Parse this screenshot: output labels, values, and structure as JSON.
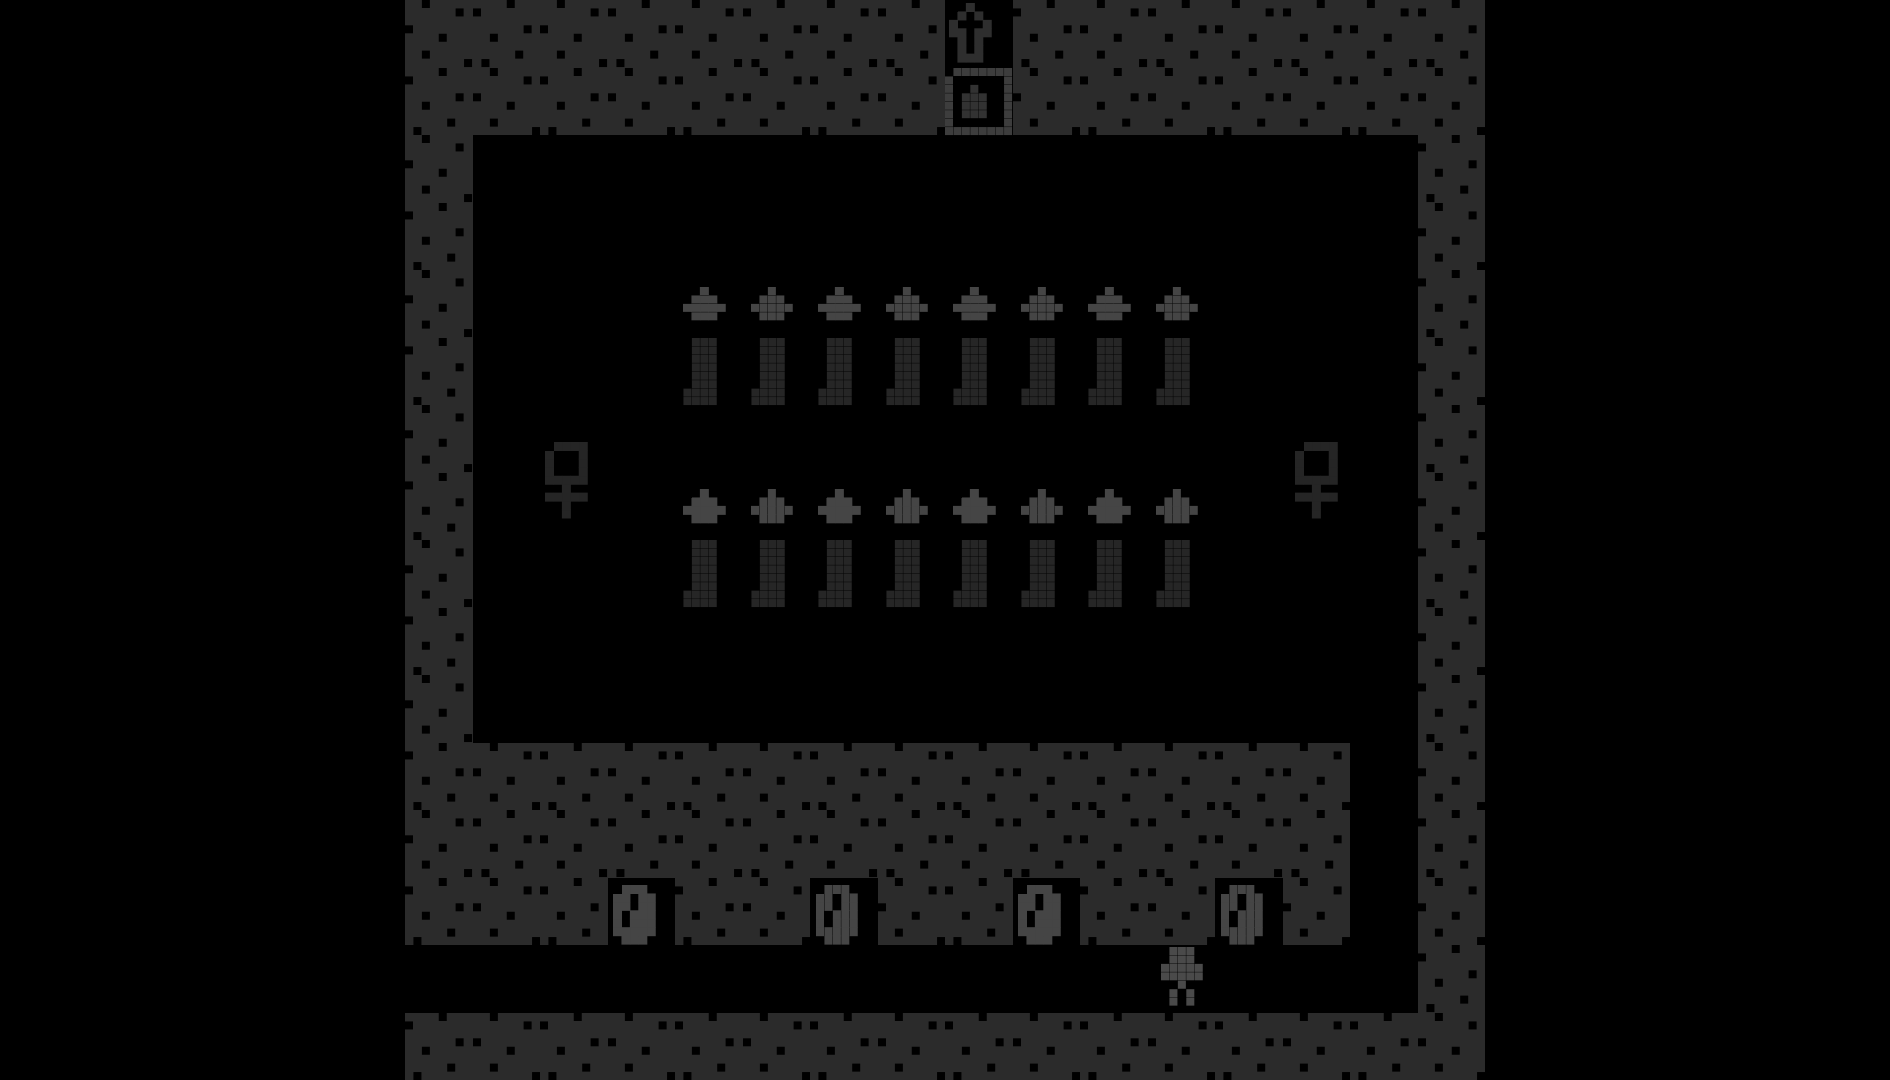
{
  "stage": {
    "width_px": 1080,
    "height_px": 1080,
    "offset_left_px": 405,
    "grid_cols": 16,
    "grid_rows": 16,
    "tile_game_px": 8,
    "background": "#000000"
  },
  "palette": {
    "letterbox": "#000000",
    "floor": "#000000",
    "wall_base": "#2b2b2b",
    "wall_dot": "#000000",
    "flame_gray": "#454545",
    "body_dark": "#262626",
    "avatar_gray": "#4a4a4a",
    "arrow_dim": "#2e2e2e",
    "crate_frame": "#3d3d3d",
    "crate_item": "#323232",
    "figure_dark": "#252525",
    "zero_gray": "#454545"
  },
  "tilemap": [
    "WWWWWWWW.WWWWWWW",
    "WWWWWWWW.WWWWWWW",
    "W..............W",
    "W..............W",
    "W..............W",
    "W..............W",
    "W..............W",
    "W..............W",
    "W..............W",
    "W..............W",
    "W..............W",
    "WWWWWWWWWWWWWW.W",
    "WWWWWWWWWWWWWW.W",
    "WWW.WW.WW.WW.W.W",
    "...............W",
    "WWWWWWWWWWWWWWWW"
  ],
  "wall_dot_patterns": [
    [
      [
        2,
        0
      ],
      [
        6,
        1
      ],
      [
        0,
        3
      ],
      [
        4,
        4
      ],
      [
        2,
        6
      ],
      [
        7,
        7
      ]
    ],
    [
      [
        4,
        0
      ],
      [
        0,
        1
      ],
      [
        6,
        3
      ],
      [
        2,
        4
      ],
      [
        5,
        6
      ],
      [
        1,
        7
      ]
    ]
  ],
  "pixel_maps": {
    "up_arrow": [
      "..X..",
      ".X.X.",
      "X...X",
      "XX.XX",
      ".X.X.",
      ".X.X.",
      ".XXX."
    ],
    "crate": [
      "FFFFFFFF",
      "F......F",
      "F..I...F",
      "F.III..F",
      "F.III..F",
      "F.III..F",
      "F......F",
      "FFFFFFFF"
    ],
    "flame": [
      "..X..",
      ".XXX.",
      "XXXXX",
      ".XXX."
    ],
    "candle_body": [
      "..XXX",
      "..XXX",
      "..XXX",
      "..XXX",
      "..XXX",
      "..XXX",
      ".XXXX",
      ".XXXX"
    ],
    "figure": [
      "XXXXX",
      "X...X",
      "X...X",
      "X...X",
      "XXXXX",
      "..X..",
      "XXXXX",
      "..X..",
      "..X.."
    ],
    "zero": [
      ".XXX.",
      "XX.XX",
      "XX.XX",
      "X.XXX",
      "X.XXX",
      "XXXXX",
      ".XXX."
    ],
    "avatar": [
      ".XXX.",
      ".XXX.",
      "XXXXX",
      "XXXXX",
      "..X..",
      ".X.X.",
      ".X.X."
    ]
  },
  "sprites": {
    "entrance_arrow": {
      "map": "up_arrow",
      "color_key": {
        "X": "arrow_dim"
      },
      "gpx": [
        64.5,
        0.4
      ]
    },
    "crate": {
      "map": "crate",
      "color_key": {
        "F": "crate_frame",
        "I": "crate_item"
      },
      "gpx": [
        64,
        8
      ]
    },
    "mirrors": {
      "map": "figure",
      "color_key": {
        "X": "figure_dark"
      },
      "positions_gpx": [
        [
          16.6,
          52.4
        ],
        [
          105.5,
          52.4
        ]
      ]
    },
    "candles": {
      "cols": [
        4,
        5,
        6,
        7,
        8,
        9,
        10,
        11
      ],
      "rows": [
        {
          "flame_row": 4,
          "body_row": 5
        },
        {
          "flame_row": 7,
          "body_row": 8
        }
      ],
      "flame_offset_gpx": [
        1,
        2
      ],
      "flame_color_key": {
        "X": "flame_gray"
      },
      "body_color_key": {
        "X": "body_dark"
      }
    },
    "zeros": {
      "glyph": "0",
      "map": "zero",
      "color_key": {
        "X": "zero_gray"
      },
      "row": 13,
      "cols": [
        3,
        6,
        9,
        12
      ],
      "offset_gpx": [
        0.7,
        0.9
      ]
    },
    "avatar": {
      "map": "avatar",
      "color_key": {
        "X": "avatar_gray"
      },
      "gpx": [
        89.6,
        112.2
      ]
    }
  }
}
